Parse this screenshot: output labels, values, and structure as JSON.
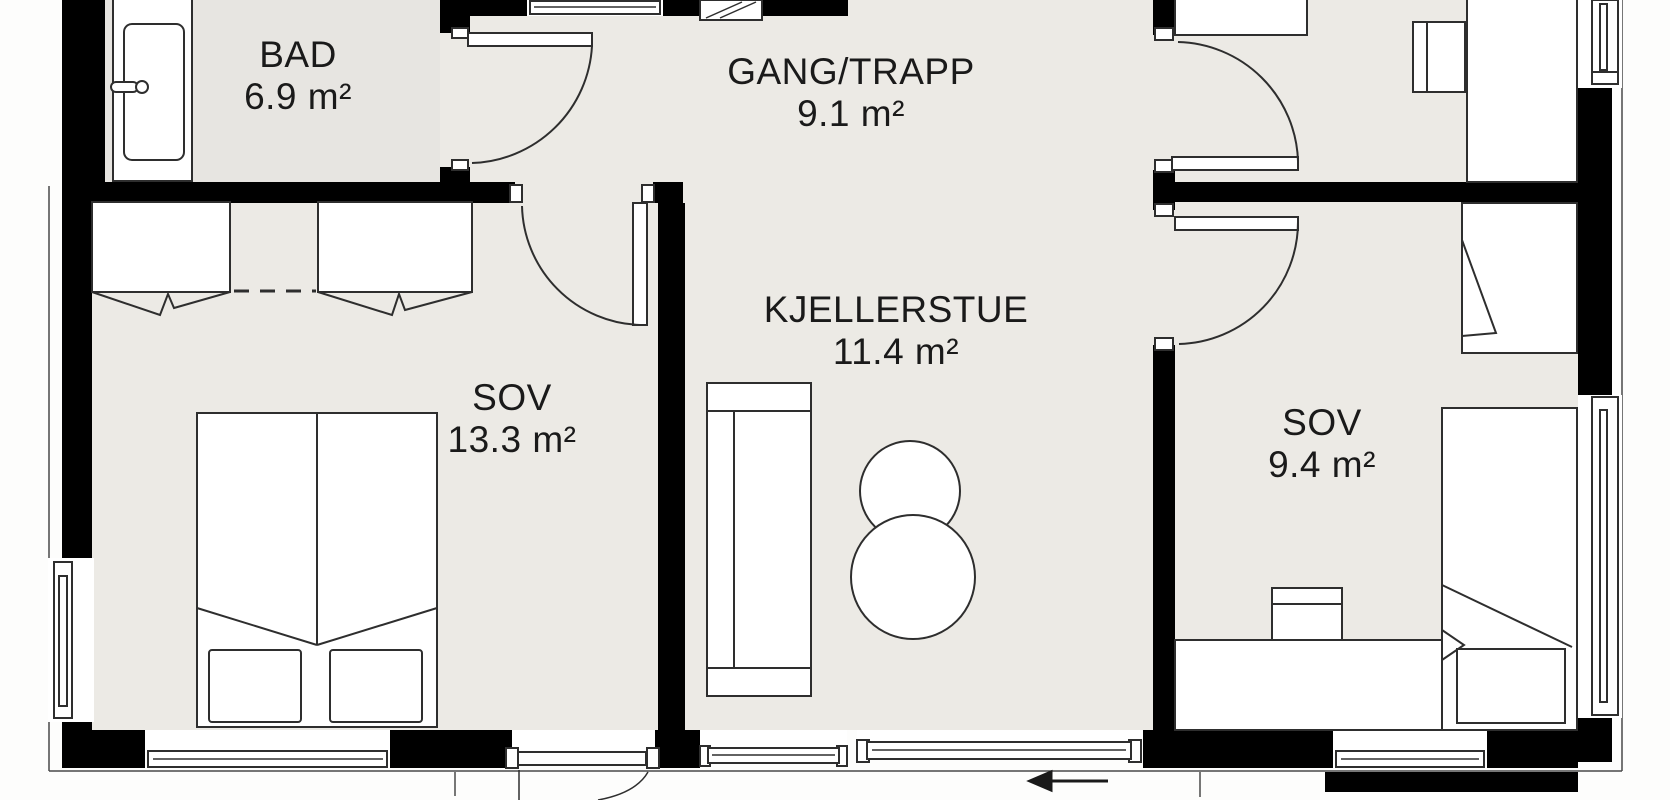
{
  "rooms": [
    {
      "name": "BAD",
      "area": "6.9 m²"
    },
    {
      "name": "GANG/TRAPP",
      "area": "9.1 m²"
    },
    {
      "name": "KJELLERSTUE",
      "area": "11.4 m²"
    },
    {
      "name": "SOV",
      "area": "13.3 m²"
    },
    {
      "name": "SOV",
      "area": "9.4 m²"
    }
  ],
  "annotations": {
    "sliding_door_arrow": "left-arrow"
  },
  "colors": {
    "wall": "#000000",
    "floor": "#eceae5",
    "floor_bad": "#e7e5e1",
    "outside": "#fdfdfc",
    "outline": "#2e2e2e",
    "thin": "#4a4a4a",
    "text": "#1a1a1a"
  }
}
